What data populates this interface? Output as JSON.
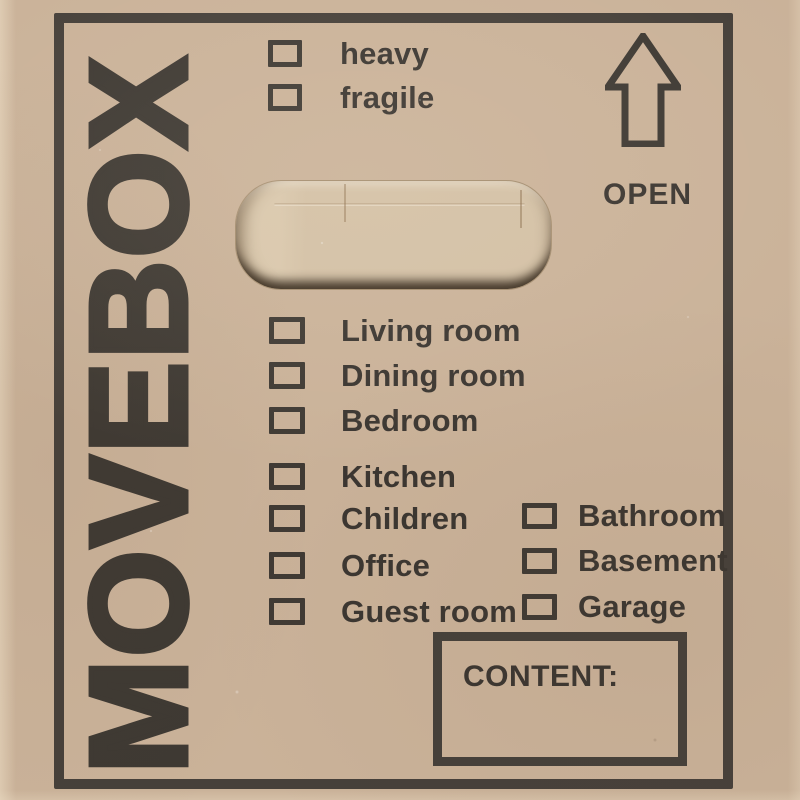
{
  "brand": {
    "name": "MOVEBOX"
  },
  "open": {
    "label": "OPEN"
  },
  "attributes": {
    "items": [
      {
        "label": "heavy",
        "checked": false
      },
      {
        "label": "fragile",
        "checked": false
      }
    ]
  },
  "checklist": {
    "rooms": [
      {
        "label": "Living room",
        "checked": false
      },
      {
        "label": "Dining room",
        "checked": false
      },
      {
        "label": "Bedroom",
        "checked": false
      },
      {
        "label": "Kitchen",
        "checked": false
      },
      {
        "label": "Children",
        "checked": false
      },
      {
        "label": "Office",
        "checked": false
      },
      {
        "label": "Guest room",
        "checked": false
      }
    ],
    "rooms_right": [
      {
        "label": "Bathroom",
        "checked": false
      },
      {
        "label": "Basement",
        "checked": false
      },
      {
        "label": "Garage",
        "checked": false
      }
    ]
  },
  "content": {
    "label": "CONTENT:",
    "value": ""
  },
  "colors": {
    "cardboard": "#cab299",
    "ink": "#3e3933",
    "frame_ink": "#46403a",
    "flap": "#d3c0a5"
  }
}
